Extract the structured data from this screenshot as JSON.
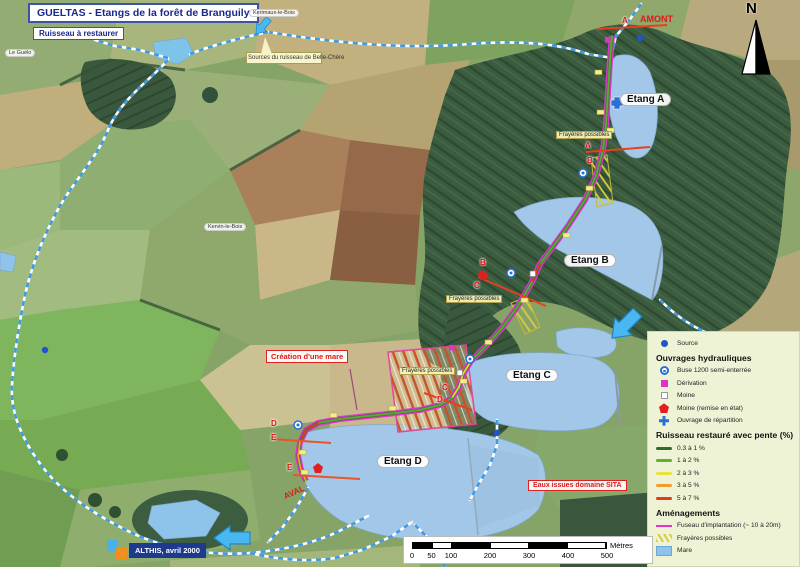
{
  "title": {
    "main": "GUELTAS - Etangs de la forêt de Branguily",
    "subtitle": "Ruisseau à restaurer"
  },
  "north_label": "N",
  "annotations": {
    "amont": "AMONT",
    "aval": "AVAL",
    "sources": "Sources du ruisseau de Belle-Chère",
    "creation_mare": "Création d'une mare",
    "eaux_sita": "Eaux issues domaine SITA",
    "frayeres": "Frayères possibles",
    "credit": "ALTHIS, avril 2000"
  },
  "places": {
    "p1": "Le Guélo",
    "p2": "Kerimaux-le-Bois",
    "p3": "Kervin-le-Bois"
  },
  "etangs": {
    "a": "Etang A",
    "b": "Etang B",
    "c": "Etang C",
    "d": "Etang D"
  },
  "section_letters": [
    "A",
    "A",
    "B",
    "B",
    "C",
    "C",
    "D",
    "D",
    "E",
    "E"
  ],
  "legend": {
    "source_label": "Source",
    "ouvrages": {
      "header": "Ouvrages hydrauliques",
      "items": [
        {
          "icon": "buse-icon",
          "label": "Buse 1200 semi-enterrée"
        },
        {
          "icon": "derivation-icon",
          "label": "Dérivation"
        },
        {
          "icon": "moine-icon",
          "label": "Moine"
        },
        {
          "icon": "moine-restaure-icon",
          "label": "Moine (remise en état)"
        },
        {
          "icon": "ouvrage-repartition-icon",
          "label": "Ouvrage de répartition"
        }
      ]
    },
    "pente": {
      "header": "Ruisseau restauré avec pente (%)",
      "items": [
        {
          "color": "#2e6b2e",
          "label": "0.3 à 1 %"
        },
        {
          "color": "#5cb52e",
          "label": "1 à 2 %"
        },
        {
          "color": "#e8e23a",
          "label": "2 à 3 %"
        },
        {
          "color": "#f0a028",
          "label": "3 à 5 %"
        },
        {
          "color": "#e23a1a",
          "label": "5 à 7 %"
        }
      ]
    },
    "amenagements": {
      "header": "Aménagements",
      "items": [
        {
          "icon": "fuseau-line-icon",
          "label": "Fuseau d'implantation (~ 10 à 20m)"
        },
        {
          "icon": "frayeres-hatch-icon",
          "label": "Frayères possibles"
        },
        {
          "icon": "mare-swatch-icon",
          "label": "Mare"
        }
      ]
    }
  },
  "scalebar": {
    "ticks": [
      "0",
      "50",
      "100",
      "200",
      "300",
      "400",
      "500"
    ],
    "unit": "Mètres"
  },
  "colors": {
    "water": "#a3c7e8",
    "fuseau_magenta": "#e532d2",
    "stream_dash_blue": "#3f9ae0",
    "accent_red": "#e02020",
    "legend_bg": "#eef3d6",
    "forest_green": "#3c5c40",
    "credit_bg": "#1e3a8f"
  }
}
